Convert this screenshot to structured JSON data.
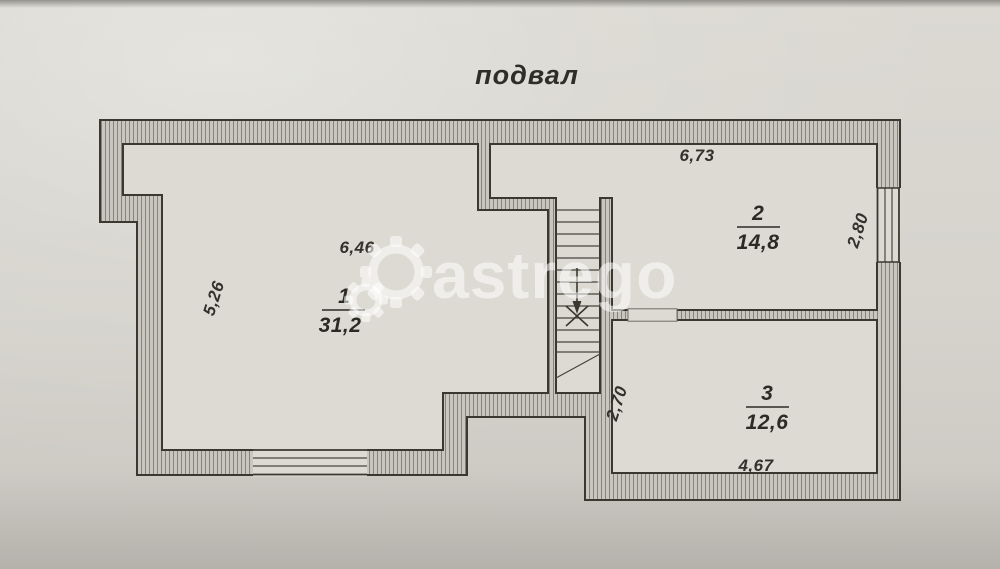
{
  "title": "подвал",
  "watermark": {
    "text": "astrego"
  },
  "rooms": [
    {
      "number": "1",
      "area": "31,2",
      "width_label": "6,46",
      "height_label": "5,26"
    },
    {
      "number": "2",
      "area": "14,8",
      "width_label": "6,73",
      "height_label": "2,80"
    },
    {
      "number": "3",
      "area": "12,6",
      "width_label": "4,67",
      "height_label": "2,70"
    }
  ],
  "colors": {
    "paper": "#d6d4cd",
    "room_fill": "#dcdad3",
    "wall_base": "#c8c6bf",
    "wall_hatch_line": "#85837b",
    "outline": "#3a382f",
    "text": "#2f2d28",
    "watermark": "rgba(255,255,255,0.55)"
  }
}
